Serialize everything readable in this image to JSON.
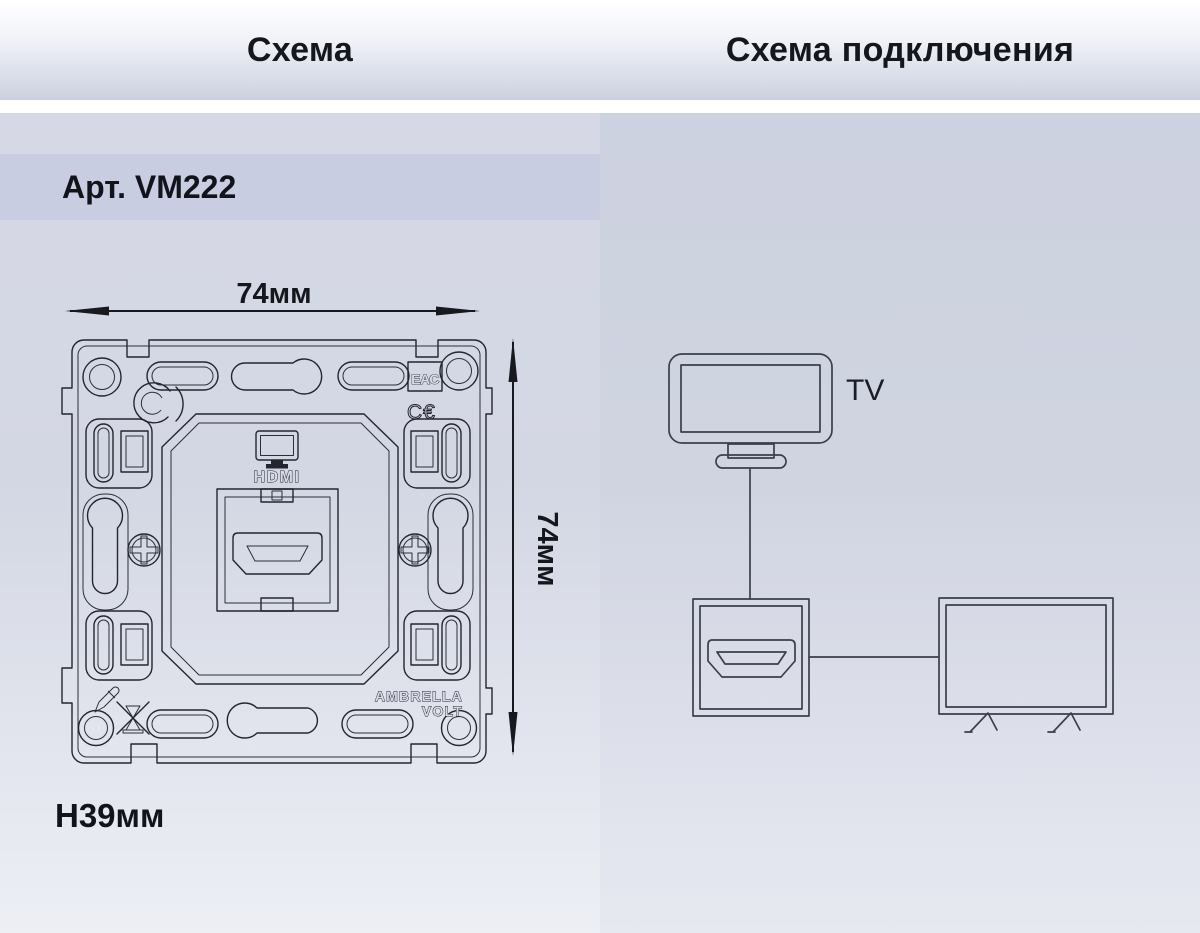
{
  "headers": {
    "left": "Схема",
    "right": "Схема подключения"
  },
  "schema_panel": {
    "article": "Арт. VM222",
    "width_dim": "74мм",
    "height_dim": "74мм",
    "mount_height": "H39мм",
    "drawing": {
      "port_label": "HDMI",
      "brand_line1": "AMBRELLA",
      "brand_line2": "VOLT",
      "eac_mark": "ЕАС",
      "ce_mark": "C€"
    }
  },
  "connection_panel": {
    "tv_label": "TV"
  },
  "colors": {
    "drawing_ink": "#23262e",
    "diagram_stroke": "#3a3f4c",
    "text": "#15171c",
    "article_band": "#c8cde2",
    "panel_left_top": "#d6d9e5",
    "panel_right_top": "#cdd2e0",
    "header_gradient_bottom": "#ccd1e0"
  }
}
